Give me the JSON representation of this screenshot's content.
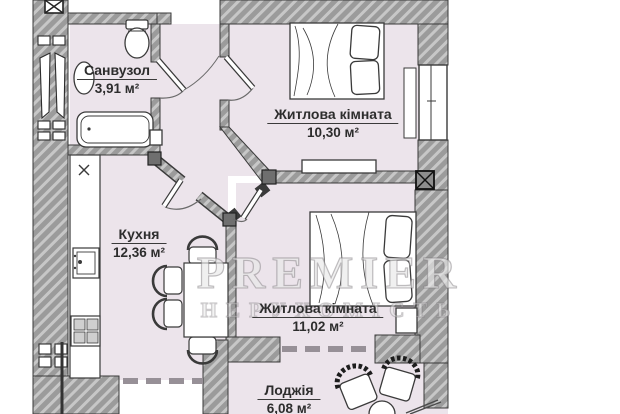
{
  "plan_title": "apartment-floor-plan",
  "watermark": {
    "line1": "PREMIER",
    "line2": "НЕРУХОМІСТЬ"
  },
  "rooms": {
    "bathroom": {
      "name": "Санвузол",
      "area": "3,91 м²"
    },
    "bedroom1": {
      "name": "Житлова кімната",
      "area": "10,30 м²"
    },
    "kitchen": {
      "name": "Кухня",
      "area": "12,36 м²"
    },
    "bedroom2": {
      "name": "Житлова кімната",
      "area": "11,02 м²"
    },
    "loggia": {
      "name": "Лоджія",
      "area": "6,08 м²"
    }
  },
  "fixtures": {
    "bathroom": [
      "toilet",
      "washbasin",
      "bathtub"
    ],
    "kitchen": [
      "counter",
      "sink",
      "stove",
      "dining-table",
      "chairs"
    ],
    "bedroom1": [
      "double-bed",
      "tv-stand",
      "window",
      "radiator"
    ],
    "bedroom2": [
      "double-bed",
      "nightstand"
    ],
    "loggia": [
      "armchair",
      "armchair",
      "round-table"
    ],
    "common": [
      "staircase",
      "ventilation-shaft",
      "column"
    ]
  },
  "colors": {
    "floor": "#ece4eb",
    "wall": "#9b9b9b",
    "wall_hatch": "#c7c7c7",
    "outline": "#3a3a3a",
    "furniture_fill": "#ffffff",
    "label_text": "#2d2d2d"
  }
}
